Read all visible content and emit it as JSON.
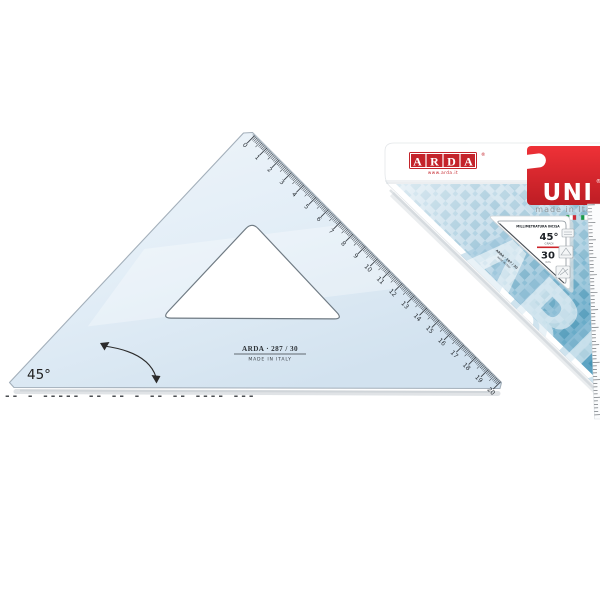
{
  "product": {
    "code_label": "ARDA · 287 / 30",
    "made_in_label": "MADE IN ITALY",
    "angle_label": "45°",
    "scale_numbers": [
      "0",
      "1",
      "2",
      "3",
      "4",
      "5",
      "6",
      "7",
      "8",
      "9",
      "10",
      "11",
      "12",
      "13",
      "14",
      "15",
      "16",
      "17",
      "18",
      "19",
      "20"
    ]
  },
  "packaging": {
    "logo": {
      "letters": [
        "A",
        "R",
        "D",
        "A"
      ],
      "registered": "®",
      "website": "www.arda.it"
    },
    "uni_tab": {
      "label": "UNI",
      "registered": "®",
      "subtitle": "made in Italy"
    },
    "spec_label": {
      "heading": "MILLIMETRATURA INCISA",
      "angle_value": "45°",
      "angle_unit": "GRADI",
      "length_value": "30",
      "length_unit": "Cm",
      "code_text": "ARDA · 287 / 30",
      "made_in_text": "MADE IN ITALY"
    },
    "watermark": "ARDA"
  },
  "bottom_caption_fragment": "-- -  ----- -- --  -  -- --  ---- ---",
  "colors": {
    "brand_red": "#c4242b",
    "uni_red": "#dd2127",
    "card_blue": "#79aecb",
    "ruler_blue": "#dce9f4",
    "flag_green": "#169b47",
    "flag_red": "#ce2b37"
  }
}
